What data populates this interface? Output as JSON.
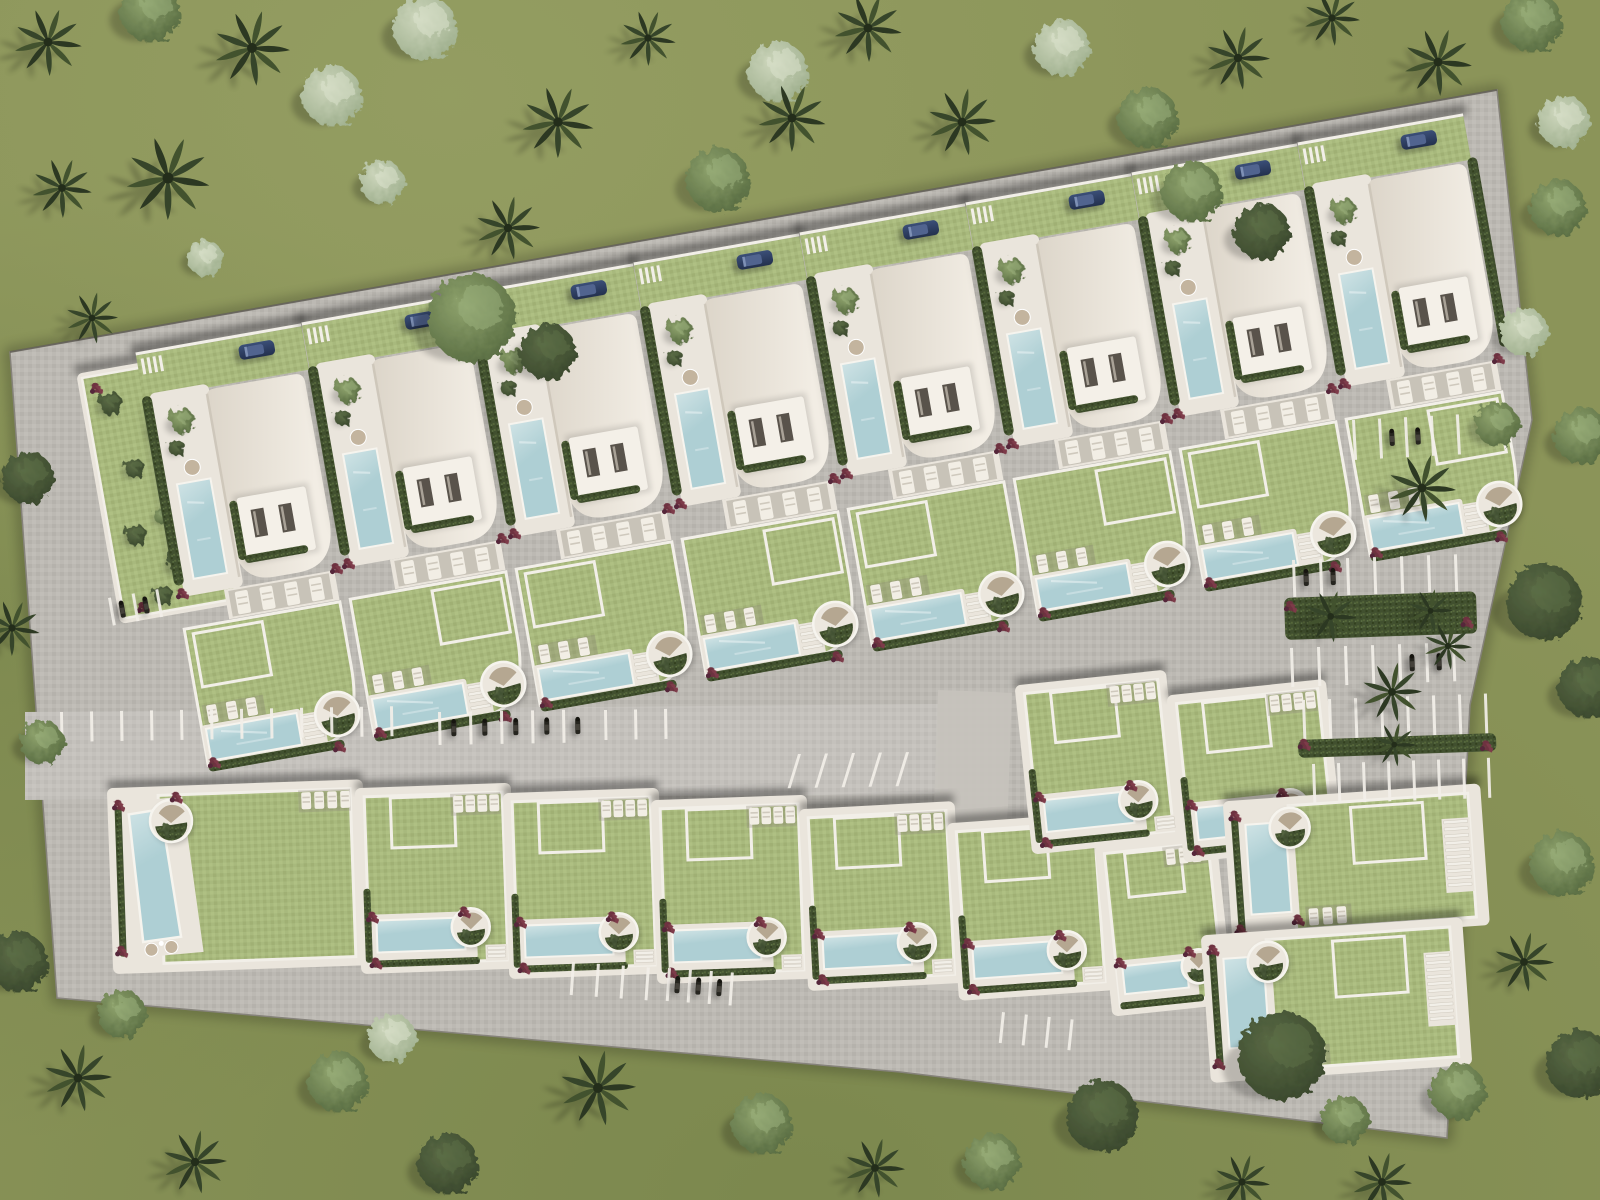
{
  "scene": {
    "label": "aerial-site-plan-villa-development-rendering",
    "canvas": {
      "w": 1600,
      "h": 1200
    },
    "colors": {
      "grass": "#8b9459",
      "grass_light": "#9aa468",
      "grass_dark": "#6f7e45",
      "road": "#bcb9b3",
      "road_light": "#c6c3bd",
      "plot_pave": "#eae5dc",
      "path": "#f2efe8",
      "roof_light": "#f2ede4",
      "roof_dark": "#dcd5c9",
      "roofbox": "#f4f0e8",
      "door": "#59534b",
      "pool": "#aecfd4",
      "pool_light": "#cfe3e5",
      "lawn": "#a8b97d",
      "hedge": "#41502f",
      "palm_dark": "#2c3822",
      "palm_mid": "#36452a",
      "palm_light": "#42522e",
      "flower": "#6e3140",
      "car_body": "#23304e",
      "car_top": "#51648f",
      "bike": "#26251f",
      "chair": "#c3b49e",
      "curb": "#85827a"
    },
    "site_outline": [
      [
        10,
        352
      ],
      [
        1497,
        90
      ],
      [
        1532,
        420
      ],
      [
        1470,
        705
      ],
      [
        1447,
        1138
      ],
      [
        900,
        1072
      ],
      [
        57,
        998
      ]
    ],
    "central_road": [
      [
        25,
        712
      ],
      [
        938,
        704
      ],
      [
        938,
        794
      ],
      [
        25,
        800
      ]
    ],
    "access_path": {
      "x": 938,
      "y": 690,
      "w": 74,
      "h": 300,
      "rot": 2
    },
    "garden_plot": {
      "x": 82,
      "y": 378,
      "rot": -10,
      "w": 114,
      "h": 244,
      "bushes": [
        [
          24,
          30,
          12
        ],
        [
          72,
          62,
          14
        ],
        [
          36,
          98,
          10
        ],
        [
          82,
          132,
          13
        ],
        [
          26,
          164,
          11
        ],
        [
          66,
          198,
          14
        ],
        [
          42,
          228,
          10
        ],
        [
          88,
          24,
          9
        ],
        [
          55,
          150,
          8
        ]
      ],
      "flowers": [
        [
          12,
          12
        ],
        [
          100,
          210
        ],
        [
          20,
          236
        ]
      ]
    },
    "top_row": {
      "count": 8,
      "origin": [
        205,
        390
      ],
      "step": [
        166,
        -30
      ],
      "rotation": -10
    },
    "bottom_row": [
      {
        "x": 112,
        "y": 793,
        "w": 246,
        "h": 176,
        "rot": -2,
        "variant": "pool-left-wedge"
      },
      {
        "x": 360,
        "y": 793,
        "w": 146,
        "h": 176,
        "rot": -2,
        "variant": "pool-bottom"
      },
      {
        "x": 508,
        "y": 798,
        "w": 146,
        "h": 176,
        "rot": -2,
        "variant": "pool-bottom"
      },
      {
        "x": 656,
        "y": 805,
        "w": 146,
        "h": 174,
        "rot": -2,
        "variant": "pool-bottom"
      },
      {
        "x": 804,
        "y": 814,
        "w": 146,
        "h": 172,
        "rot": -3,
        "variant": "pool-bottom"
      },
      {
        "x": 952,
        "y": 828,
        "w": 146,
        "h": 168,
        "rot": -4,
        "variant": "pool-bottom"
      },
      {
        "x": 1100,
        "y": 850,
        "w": 112,
        "h": 162,
        "rot": -6,
        "variant": "pool-bottom-narrow"
      }
    ],
    "mid_right_plots": [
      {
        "x": 1020,
        "y": 690,
        "w": 142,
        "h": 160,
        "rot": -6,
        "variant": "pool-bottom"
      },
      {
        "x": 1172,
        "y": 700,
        "w": 150,
        "h": 158,
        "rot": -6,
        "variant": "pool-bottom"
      }
    ],
    "right_cluster": [
      {
        "x": 1228,
        "y": 806,
        "w": 248,
        "h": 132,
        "rot": -4,
        "variant": "pool-left"
      },
      {
        "x": 1206,
        "y": 940,
        "w": 252,
        "h": 138,
        "rot": -4,
        "variant": "pool-left"
      }
    ],
    "parking_groups": [
      {
        "x": 60,
        "y": 712,
        "rot": -1,
        "count": 12,
        "gap": 30,
        "len": 30,
        "bikes": []
      },
      {
        "x": 438,
        "y": 712,
        "rot": -1,
        "count": 5,
        "gap": 31,
        "len": 33,
        "bikes": [
          0,
          1,
          2,
          3,
          4
        ]
      },
      {
        "x": 604,
        "y": 710,
        "rot": -1,
        "count": 3,
        "gap": 30,
        "len": 30,
        "bikes": []
      },
      {
        "x": 798,
        "y": 754,
        "rot": -1,
        "count": 5,
        "gap": 27,
        "len": 34,
        "skew": -18,
        "bikes": []
      },
      {
        "x": 108,
        "y": 598,
        "rot": -10,
        "count": 3,
        "gap": 24,
        "len": 28,
        "bikes": [
          0,
          1
        ]
      },
      {
        "x": 572,
        "y": 962,
        "rot": 4,
        "count": 4,
        "gap": 25,
        "len": 33,
        "bikes": []
      },
      {
        "x": 668,
        "y": 968,
        "rot": 4,
        "count": 4,
        "gap": 21,
        "len": 33,
        "bikes": [
          0,
          1,
          2
        ]
      },
      {
        "x": 1002,
        "y": 1012,
        "rot": 6,
        "count": 4,
        "gap": 23,
        "len": 31,
        "bikes": []
      },
      {
        "x": 1292,
        "y": 560,
        "rot": -2,
        "count": 7,
        "gap": 27,
        "len": 37,
        "bikes": [
          0,
          1
        ]
      },
      {
        "x": 1290,
        "y": 648,
        "rot": -2,
        "count": 7,
        "gap": 27,
        "len": 39,
        "bikes": [
          4,
          5
        ]
      },
      {
        "x": 1302,
        "y": 700,
        "rot": -2,
        "count": 8,
        "gap": 26,
        "len": 40,
        "bikes": []
      },
      {
        "x": 1312,
        "y": 764,
        "rot": -2,
        "count": 8,
        "gap": 25,
        "len": 40,
        "bikes": []
      },
      {
        "x": 1352,
        "y": 420,
        "rot": -3,
        "count": 5,
        "gap": 26,
        "len": 40,
        "bikes": [
          1,
          2
        ]
      }
    ],
    "hedge_islands": [
      {
        "x": 1284,
        "y": 598,
        "w": 192,
        "h": 42,
        "rot": -2,
        "palms": [
          [
            46,
            20,
            26
          ],
          [
            146,
            18,
            22
          ]
        ],
        "flowers": [
          [
            6,
            8
          ],
          [
            182,
            30
          ]
        ]
      },
      {
        "x": 1298,
        "y": 740,
        "w": 198,
        "h": 18,
        "rot": -2,
        "palms": [
          [
            96,
            8,
            22
          ]
        ],
        "flowers": [
          [
            6,
            4
          ],
          [
            188,
            12
          ]
        ]
      }
    ],
    "trees": [
      [
        "palm",
        48,
        42,
        34
      ],
      [
        "palm",
        252,
        48,
        38
      ],
      [
        "bm",
        150,
        12,
        30
      ],
      [
        "palm",
        168,
        178,
        42
      ],
      [
        "palm",
        62,
        188,
        30
      ],
      [
        "bl",
        332,
        96,
        30
      ],
      [
        "bl",
        425,
        28,
        32
      ],
      [
        "palm",
        558,
        122,
        36
      ],
      [
        "palm",
        648,
        38,
        28
      ],
      [
        "bm",
        718,
        180,
        32
      ],
      [
        "palm",
        508,
        228,
        32
      ],
      [
        "bl",
        382,
        182,
        22
      ],
      [
        "bl",
        205,
        258,
        18
      ],
      [
        "palm",
        92,
        318,
        26
      ],
      [
        "bl",
        778,
        72,
        30
      ],
      [
        "palm",
        868,
        28,
        34
      ],
      [
        "palm",
        962,
        122,
        34
      ],
      [
        "bl",
        1062,
        48,
        28
      ],
      [
        "bm",
        1148,
        118,
        30
      ],
      [
        "palm",
        1238,
        58,
        32
      ],
      [
        "palm",
        1332,
        18,
        28
      ],
      [
        "palm",
        1438,
        62,
        34
      ],
      [
        "bm",
        1532,
        22,
        30
      ],
      [
        "bl",
        1564,
        122,
        26
      ],
      [
        "bm",
        1558,
        208,
        28
      ],
      [
        "bl",
        1524,
        332,
        24
      ],
      [
        "bm",
        1582,
        436,
        28
      ],
      [
        "bd",
        1544,
        602,
        38
      ],
      [
        "bd",
        1588,
        688,
        30
      ],
      [
        "bm",
        1562,
        864,
        32
      ],
      [
        "palm",
        1524,
        962,
        30
      ],
      [
        "bd",
        1580,
        1064,
        34
      ],
      [
        "bm",
        472,
        318,
        44
      ],
      [
        "bd",
        548,
        352,
        28
      ],
      [
        "palm",
        792,
        118,
        34
      ],
      [
        "bm",
        1192,
        192,
        30
      ],
      [
        "bd",
        1262,
        232,
        28
      ],
      [
        "palm",
        1422,
        488,
        34
      ],
      [
        "bm",
        1497,
        424,
        22
      ],
      [
        "palm",
        1392,
        692,
        30
      ],
      [
        "palm",
        1448,
        646,
        24
      ],
      [
        "bd",
        1282,
        1056,
        44
      ],
      [
        "bm",
        1345,
        1120,
        24
      ],
      [
        "bd",
        18,
        962,
        30
      ],
      [
        "bm",
        122,
        1014,
        24
      ],
      [
        "palm",
        78,
        1078,
        34
      ],
      [
        "palm",
        195,
        1162,
        32
      ],
      [
        "bm",
        338,
        1082,
        30
      ],
      [
        "bl",
        392,
        1038,
        24
      ],
      [
        "bd",
        448,
        1164,
        30
      ],
      [
        "palm",
        598,
        1088,
        38
      ],
      [
        "bm",
        762,
        1124,
        30
      ],
      [
        "palm",
        875,
        1168,
        30
      ],
      [
        "bm",
        992,
        1162,
        28
      ],
      [
        "bd",
        1102,
        1116,
        36
      ],
      [
        "palm",
        1242,
        1182,
        28
      ],
      [
        "bm",
        1458,
        1092,
        28
      ],
      [
        "palm",
        1382,
        1182,
        30
      ],
      [
        "bd",
        28,
        478,
        26
      ],
      [
        "palm",
        12,
        628,
        28
      ],
      [
        "bm",
        42,
        742,
        22
      ]
    ]
  }
}
